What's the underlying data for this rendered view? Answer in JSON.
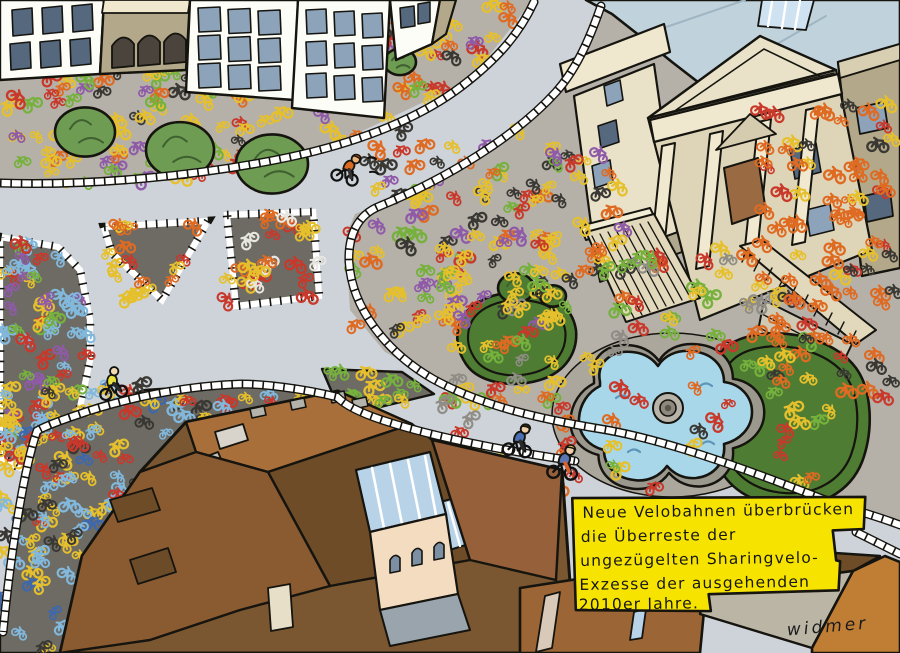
{
  "artwork": {
    "type": "editorial-cartoon-aerial-city-scene",
    "caption": {
      "lines": [
        "Neue Velobahnen überbrücken",
        "die Überreste der",
        "ungezügelten Sharingvelo-",
        "Exzesse der ausgehenden",
        "2010er Jahre."
      ],
      "bg_color": "#f6e400",
      "text_color": "#161616"
    },
    "signature": "widmer",
    "palette": {
      "road": "#cdd3d8",
      "plaza": "#b5b1a9",
      "bike_mass_bg": "#6d6b64",
      "lawn": "#8cc14e",
      "hedge": "#4e7c33",
      "bush": "#6f9c53",
      "pond": "#a9d7ea",
      "pond_rim": "#9b988e",
      "gravel": "#aba79d",
      "facade_white": "#fdfdf8",
      "facade_tan": "#b3a88a",
      "church_stone": "#e9e2c8",
      "church_stone_light": "#efe8cf",
      "church_wall": "#ded5b8",
      "church_roof": "#c0d2dc",
      "door_brown": "#9a6b42",
      "window_blue": "#8da3ba",
      "window_dark": "#55687e",
      "roof_light": "#a86f3a",
      "roof_dark": "#6e4c28",
      "roof_mid": "#96613a",
      "roof_base": "#7a5730",
      "roof_low": "#8a5a30",
      "roof_orange": "#c07e35",
      "roof_gray": "#bbb5a6",
      "courtyard_cream": "#f4dcc0",
      "veranda_blue": "#b8d3e8",
      "stair_stone": "#e2d9bc",
      "outline": "#15140f"
    },
    "bike_colors": {
      "yellow": "#e6c02c",
      "red": "#c9392b",
      "orange": "#df6a22",
      "purple": "#8f5aa8",
      "green": "#76b13d",
      "light_blue": "#82b8dc",
      "blue": "#3e68ae",
      "gray": "#8f8d85",
      "dark": "#3a3833",
      "white": "#e8e6e0"
    }
  }
}
